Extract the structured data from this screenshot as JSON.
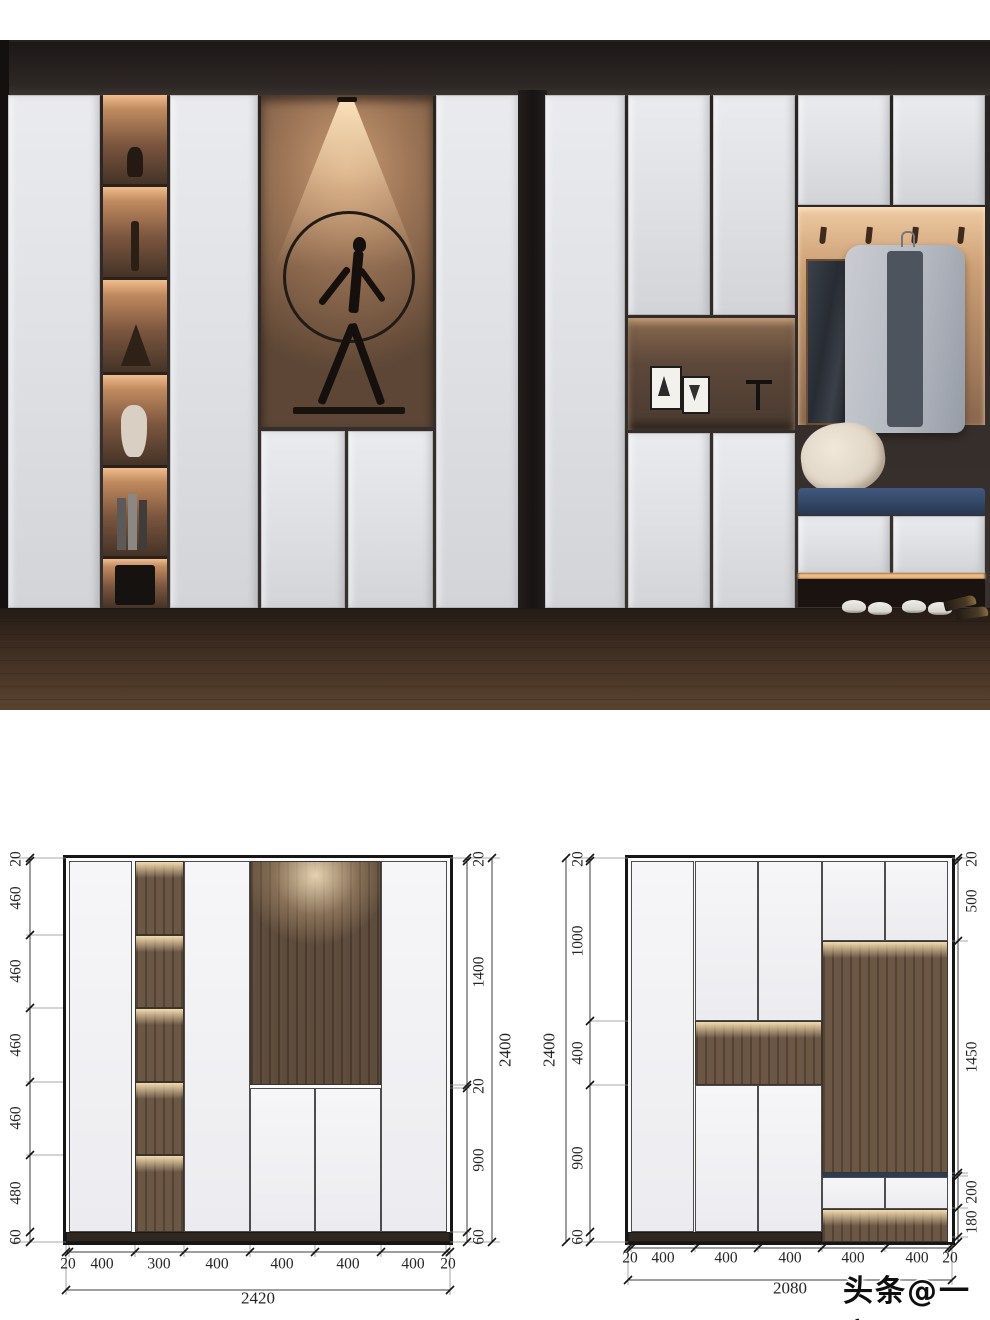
{
  "watermark": {
    "text": "头条@一室"
  },
  "palette": {
    "glow": "#f0c492",
    "wood": "#6b5745",
    "navy": "#2b3c55",
    "wall": "#332c29",
    "floor": "#4a3627",
    "accent_red": "#0e0e0e"
  },
  "diagram_left": {
    "overall_width": "2420",
    "overall_height": "2400",
    "left_dims": [
      "20",
      "460",
      "460",
      "460",
      "460",
      "480",
      "60"
    ],
    "right_dims": [
      "20",
      "1400",
      "20",
      "900",
      "60"
    ],
    "bottom_dims": [
      "20",
      "400",
      "300",
      "400",
      "400",
      "400",
      "400",
      "20"
    ]
  },
  "diagram_right": {
    "overall_width": "2080",
    "overall_height": "2400",
    "left_dims": [
      "20",
      "1000",
      "400",
      "900",
      "60"
    ],
    "right_dims": [
      "20",
      "500",
      "1450",
      "200",
      "180"
    ],
    "bottom_dims": [
      "20",
      "400",
      "400",
      "400",
      "400",
      "400",
      "20"
    ]
  }
}
